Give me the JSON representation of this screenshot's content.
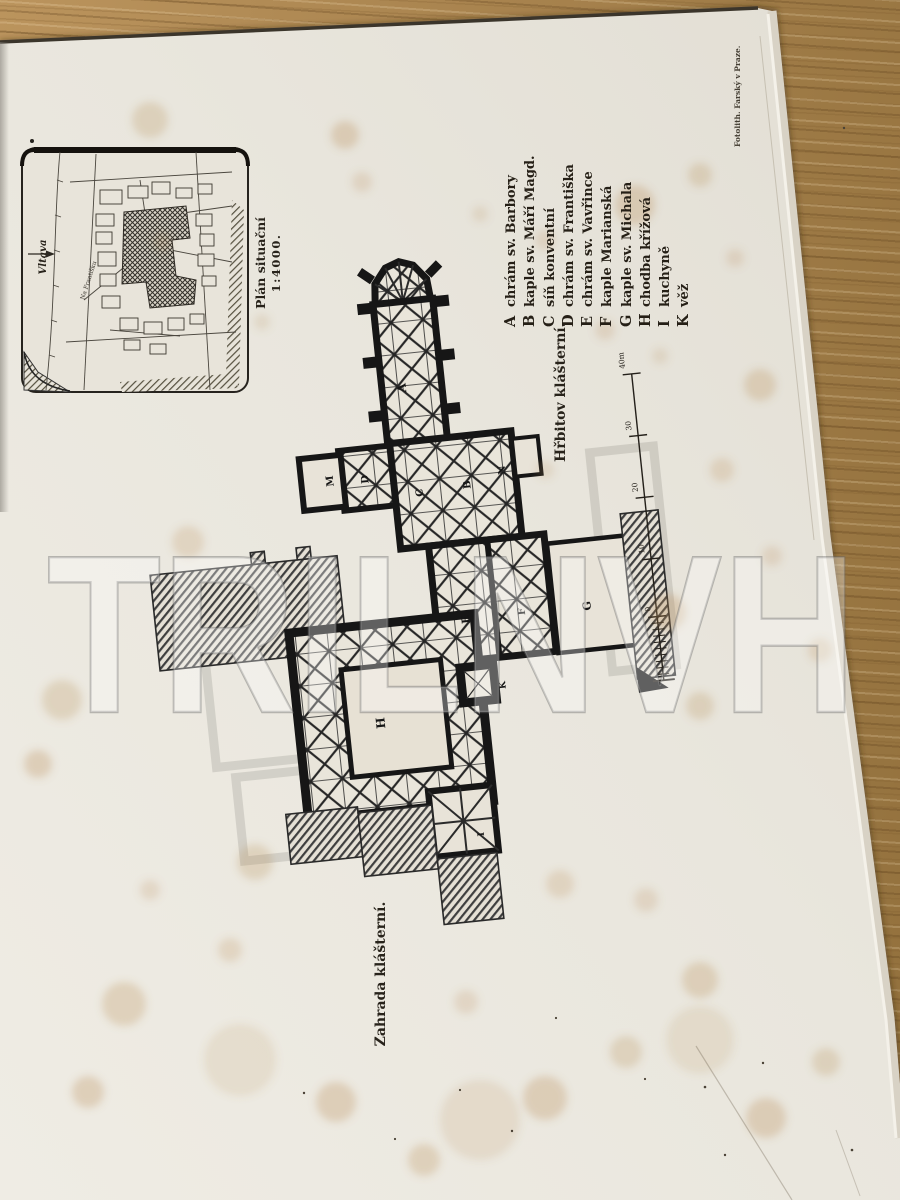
{
  "watermark": "TRILNVH",
  "imprint": "Fotolith. Farský v Praze.",
  "inset": {
    "title": "Plán situační",
    "scale": "1:4000.",
    "river": "Vltava",
    "street": "Na Františku"
  },
  "legend": [
    {
      "key": "A",
      "label": "chrám sv. Barbory"
    },
    {
      "key": "B",
      "label": "kaple sv. Máří Magd."
    },
    {
      "key": "C",
      "label": "síň konventní"
    },
    {
      "key": "D",
      "label": "chrám sv. Františka"
    },
    {
      "key": "E",
      "label": "chrám sv. Vavřince"
    },
    {
      "key": "F",
      "label": "kaple Marianská"
    },
    {
      "key": "G",
      "label": "kaple sv. Michala"
    },
    {
      "key": "H",
      "label": "chodba křížová"
    },
    {
      "key": "I",
      "label": "kuchyně"
    },
    {
      "key": "K",
      "label": "věž"
    }
  ],
  "areas": {
    "cemetery": "Hřbitov klášterní.",
    "garden": "Zahrada klášterní."
  },
  "plan": {
    "letters": {
      "a": "A",
      "b": "B",
      "c": "C",
      "d": "D",
      "e": "E",
      "f": "F",
      "g": "G",
      "h": "H",
      "i": "I",
      "k": "K",
      "m": "M",
      "n": "N"
    }
  },
  "scalebar": {
    "labels": [
      "40m",
      "30",
      "20",
      "10",
      "0"
    ]
  }
}
